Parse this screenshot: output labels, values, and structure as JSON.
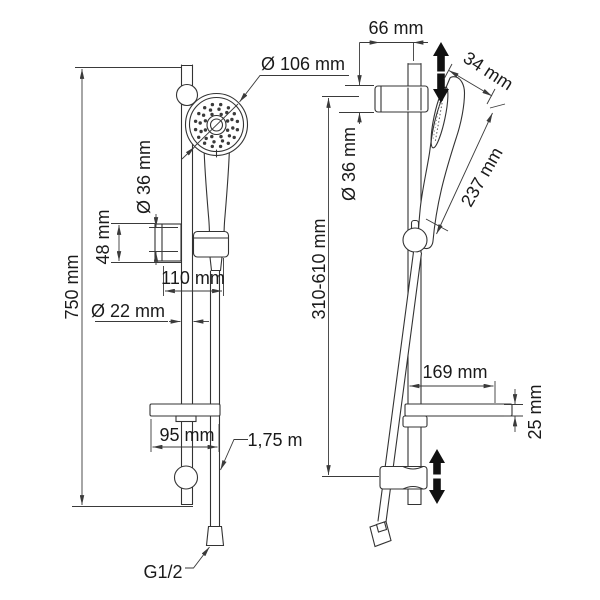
{
  "figure": {
    "style": {
      "ink": "#333333",
      "background": "#ffffff"
    },
    "front_view": {
      "rail_height": "750 mm",
      "head_diameter": "Ø 106 mm",
      "holder_diameter": "Ø 36 mm",
      "holder_height": "48 mm",
      "holder_width": "110 mm",
      "rail_diameter": "Ø 22 mm",
      "shelf_width": "95 mm",
      "hose_length": "1,75 m",
      "connection_thread": "G1/2"
    },
    "side_view": {
      "bracket_offset": "66 mm",
      "head_thickness": "34 mm",
      "head_length": "237 mm",
      "bracket_diameter": "Ø 36 mm",
      "adjustment_range": "310-610 mm",
      "shelf_depth": "169 mm",
      "shelf_thickness": "25 mm"
    }
  }
}
